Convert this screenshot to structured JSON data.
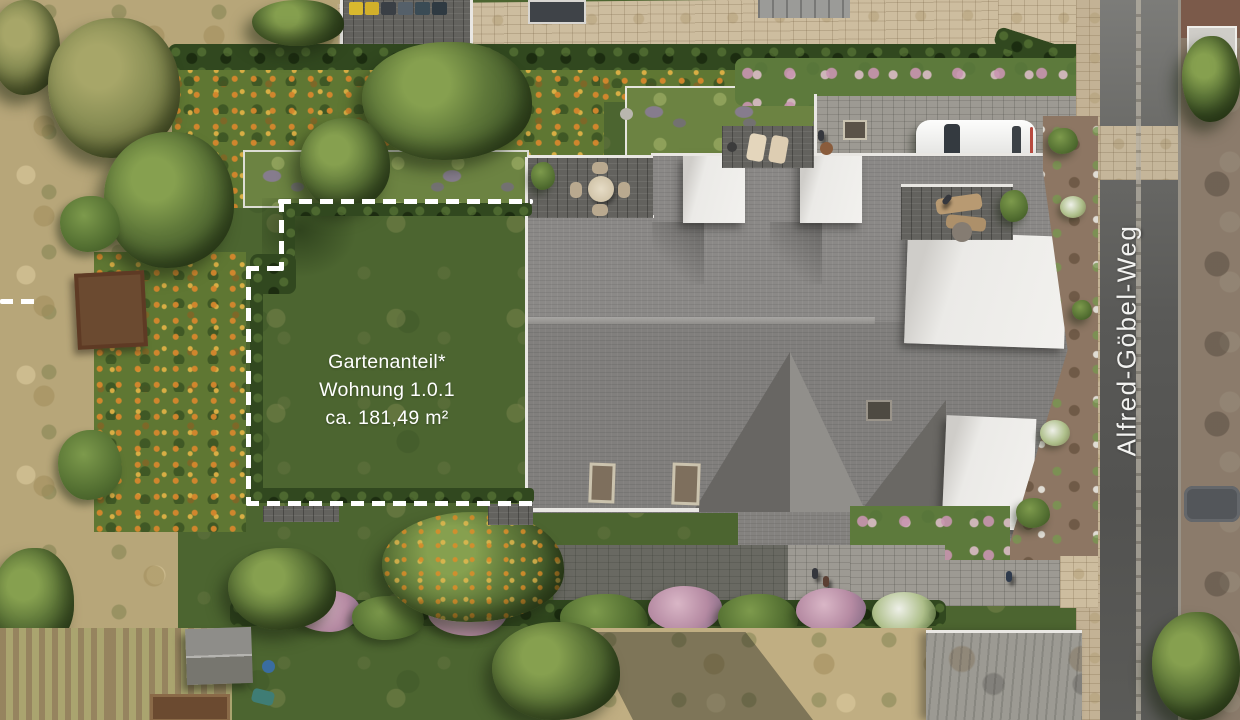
{
  "labels": {
    "garden_plot": {
      "line1": "Gartenanteil*",
      "line2": "Wohnung 1.0.1",
      "line3": "ca. 181,49 m²"
    },
    "street": "Alfred-Göbel-Weg"
  },
  "palette": {
    "lawn_green": "#4c6530",
    "meadow_orange": "#d0872e",
    "hedge_green": "#31481f",
    "roof_gray": "#8b8987",
    "dormer_white": "#eceae7",
    "cobble_beige": "#cdbd9f",
    "asphalt_gray": "#5c5c59",
    "green_roof_purple": "#8c7ba0",
    "boundary_dash_white": "#ffffff",
    "car_white": "#f0efec"
  }
}
